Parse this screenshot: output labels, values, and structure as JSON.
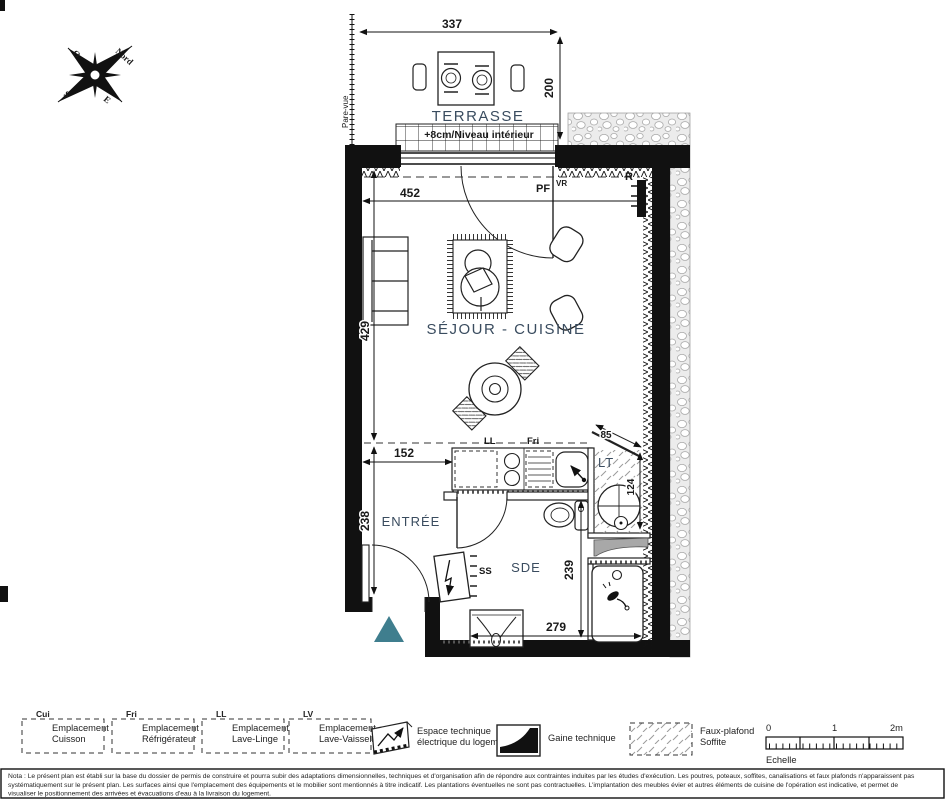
{
  "compass": {
    "north": "Nord",
    "west": "O",
    "south": "S",
    "east": "E"
  },
  "terrace": {
    "name": "TERRASSE",
    "level": "+8cm/Niveau intérieur",
    "screen": "Pare-vue"
  },
  "rooms": {
    "living": "SÉJOUR - CUISINE",
    "entry": "ENTRÉE",
    "bath": "SDE",
    "tech": "LT"
  },
  "dims": {
    "terrace_w": "337",
    "terrace_d": "200",
    "bay": "452",
    "living_h": "429",
    "entry_w": "152",
    "entry_h": "238",
    "bath_h": "239",
    "bath_w": "279",
    "tech_h": "124",
    "tech_door": "85"
  },
  "tags": {
    "bay": "PF",
    "shutter": "VR",
    "radiator": "R",
    "board": "SS",
    "washer": "LL",
    "fridge": "Fri"
  },
  "legend": {
    "slots": [
      {
        "abbr": "Cui",
        "l1": "Emplacement",
        "l2": "Cuisson"
      },
      {
        "abbr": "Fri",
        "l1": "Emplacement",
        "l2": "Réfrigérateur"
      },
      {
        "abbr": "LL",
        "l1": "Emplacement",
        "l2": "Lave-Linge"
      },
      {
        "abbr": "LV",
        "l1": "Emplacement",
        "l2": "Lave-Vaisselle"
      }
    ],
    "elec_l1": "Espace technique",
    "elec_l2": "électrique du logement",
    "duct": "Gaine technique",
    "ceiling_l1": "Faux-plafond",
    "ceiling_l2": "Soffite",
    "scale": {
      "t0": "0",
      "t1": "1",
      "t2": "2m",
      "label": "Echelle"
    }
  },
  "note": {
    "l1": "Nota : Le présent plan est établi sur la base du dossier de permis de construire et pourra subir des adaptations dimensionnelles, techniques et d'organisation afin de répondre aux contraintes induites par les études d'exécution. Les poutres, poteaux, soffites, canalisations et faux plafonds n'apparaissent pas",
    "l2": "systématiquement sur le présent plan. Les surfaces ainsi que l'emplacement des équipements et le mobilier sont mentionnés à titre indicatif. Les plantations éventuelles ne sont pas contractuelles. L'implantation des meubles évier et autres éléments de cuisine de l'opération est indicative, et permet de",
    "l3": "visualiser le positionnement des arrivées et évacuations d'eau à la livraison du logement."
  },
  "colors": {
    "room_label": "#3a4c5f",
    "entry_marker": "#3f7e8e",
    "wall": "#111111"
  }
}
